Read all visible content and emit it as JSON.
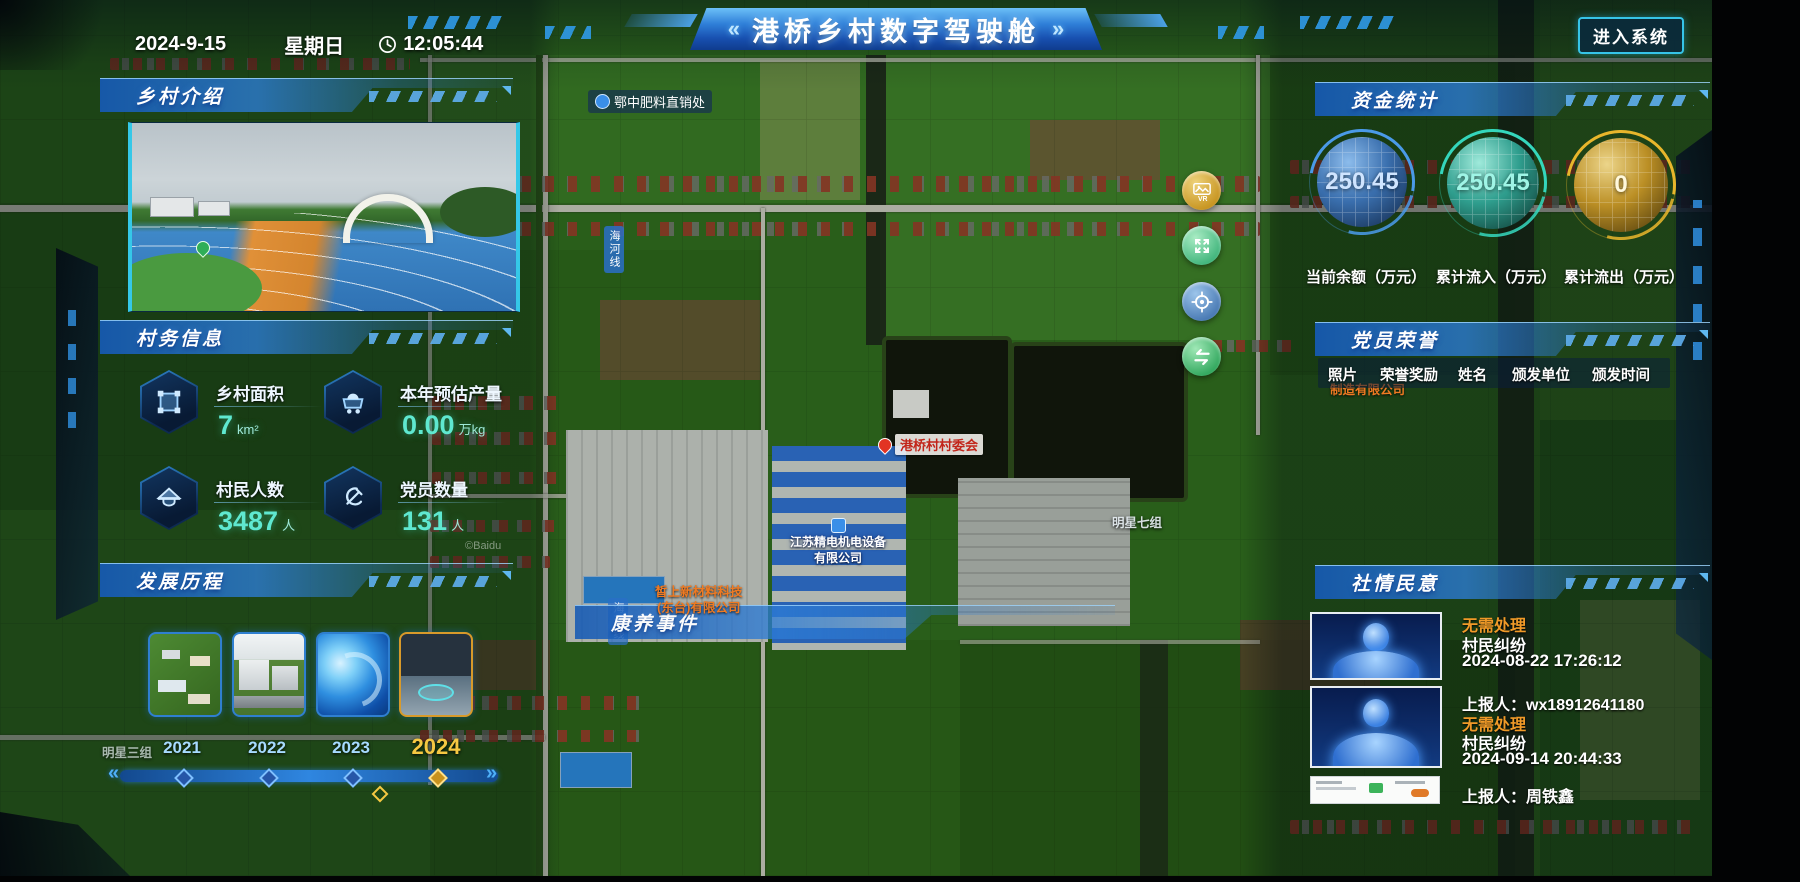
{
  "header": {
    "date": "2024-9-15",
    "weekday": "星期日",
    "time": "12:05:44",
    "title": "港桥乡村数字驾驶舱",
    "title_left_deco": "«",
    "title_right_deco": "»",
    "enter_button": "进入系统"
  },
  "panels": {
    "village_intro": {
      "title": "乡村介绍"
    },
    "village_info": {
      "title": "村务信息",
      "stats": [
        {
          "icon": "area-icon",
          "label": "乡村面积",
          "value": "7",
          "unit": "km²"
        },
        {
          "icon": "cart-icon",
          "label": "本年预估产量",
          "value": "0.00",
          "unit": "万kg"
        },
        {
          "icon": "farmer-hat-icon",
          "label": "村民人数",
          "value": "3487",
          "unit": "人"
        },
        {
          "icon": "hammer-sickle-icon",
          "label": "党员数量",
          "value": "131",
          "unit": "人"
        }
      ]
    },
    "development": {
      "title": "发展历程",
      "years": [
        {
          "label": "2021"
        },
        {
          "label": "2022"
        },
        {
          "label": "2023"
        },
        {
          "label": "2024"
        }
      ],
      "prev_arrow": "«",
      "next_arrow": "»"
    },
    "funds": {
      "title": "资金统计",
      "gauges": [
        {
          "value": "250.45",
          "label": "当前余额（万元）",
          "color": "#4a9ae8"
        },
        {
          "value": "250.45",
          "label": "累计流入（万元）",
          "color": "#35d6bc"
        },
        {
          "value": "0",
          "label": "累计流出（万元）",
          "color": "#e8b62c"
        }
      ]
    },
    "party_honor": {
      "title": "党员荣誉",
      "columns": [
        "照片",
        "荣誉奖励",
        "姓名",
        "颁发单位",
        "颁发时间"
      ]
    },
    "public_opinion": {
      "title": "社情民意",
      "items": [
        {
          "status": "无需处理",
          "type": "村民纠纷",
          "time": "2024-08-22 17:26:12",
          "reporter": "上报人：wx18912641180"
        },
        {
          "status": "无需处理",
          "type": "村民纠纷",
          "time": "2024-09-14 20:44:33",
          "reporter": "上报人：周铁鑫"
        }
      ]
    },
    "event_band": {
      "title": "康养事件"
    }
  },
  "map": {
    "watermark": "©Baidu",
    "labels": {
      "fertilizer": "鄂中肥料直销处",
      "committee": "港桥村村委会",
      "jingdian_line1": "江苏精电机电设备",
      "jingdian_line2": "有限公司",
      "xinshang_line1": "皙上新材料科技",
      "xinshang_line2": "(东台)有限公司",
      "manufacture": "制造有限公司",
      "mingxing7": "明星七组",
      "mingxing3": "明星三组",
      "road1": "海河线",
      "road2": "海河线"
    },
    "controls": [
      "vr-image-icon",
      "fullscreen-icon",
      "locate-icon",
      "swap-arrows-icon"
    ]
  }
}
